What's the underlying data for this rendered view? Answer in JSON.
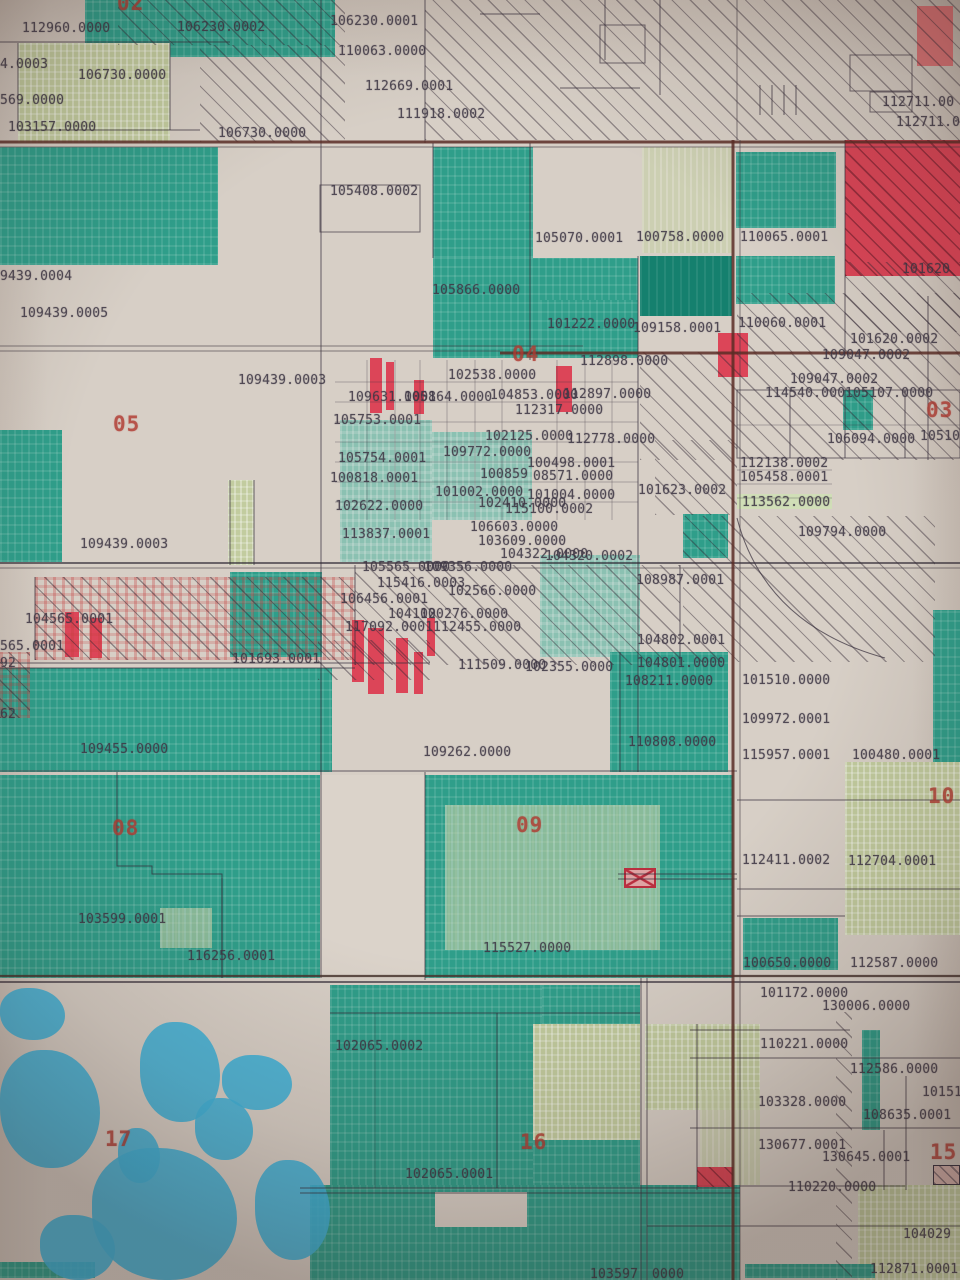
{
  "map": {
    "description": "Photographed cadastral parcel map with section numbers and parcel ID labels",
    "colors": {
      "paper": "#d7cfc6",
      "parcel_teal": "#2f9e8a",
      "parcel_teal_dark": "#15806e",
      "parcel_sage": "#c2cc9f",
      "parcel_red": "#dc3a4e",
      "water_blue": "#3fb3d9",
      "boundary_line": "#352d3a",
      "road_line": "#5a2d26",
      "label_text": "#3e3745",
      "section_text": "#b03a31"
    },
    "section_labels": [
      {
        "t": "02",
        "x": 117,
        "y": -7
      },
      {
        "t": "03",
        "x": 926,
        "y": 400
      },
      {
        "t": "04",
        "x": 512,
        "y": 344
      },
      {
        "t": "05",
        "x": 113,
        "y": 414
      },
      {
        "t": "08",
        "x": 112,
        "y": 818
      },
      {
        "t": "09",
        "x": 516,
        "y": 815
      },
      {
        "t": "10",
        "x": 928,
        "y": 786
      },
      {
        "t": "15",
        "x": 930,
        "y": 1142
      },
      {
        "t": "16",
        "x": 520,
        "y": 1132
      },
      {
        "t": "17",
        "x": 105,
        "y": 1129
      }
    ],
    "parcel_labels": [
      {
        "t": "112960.0000",
        "x": 22,
        "y": 22
      },
      {
        "t": "106230.0002",
        "x": 177,
        "y": 21
      },
      {
        "t": "4.0003",
        "x": 0,
        "y": 58
      },
      {
        "t": "106730.0000",
        "x": 78,
        "y": 69
      },
      {
        "t": "569.0000",
        "x": 0,
        "y": 94
      },
      {
        "t": "103157.0000",
        "x": 8,
        "y": 121
      },
      {
        "t": "106730.0000",
        "x": 218,
        "y": 127
      },
      {
        "t": "106230.0001",
        "x": 330,
        "y": 15
      },
      {
        "t": "110063.0000",
        "x": 338,
        "y": 45
      },
      {
        "t": "112669.0001",
        "x": 365,
        "y": 80
      },
      {
        "t": "111918.0002",
        "x": 397,
        "y": 108
      },
      {
        "t": "105408.0002",
        "x": 330,
        "y": 185
      },
      {
        "t": "105070.0001",
        "x": 535,
        "y": 232
      },
      {
        "t": "100758.0000",
        "x": 636,
        "y": 231
      },
      {
        "t": "110065.0001",
        "x": 740,
        "y": 231
      },
      {
        "t": "112711.00",
        "x": 882,
        "y": 96
      },
      {
        "t": "112711.0",
        "x": 896,
        "y": 116
      },
      {
        "t": "101620",
        "x": 902,
        "y": 263
      },
      {
        "t": "105866.0000",
        "x": 432,
        "y": 284
      },
      {
        "t": "101222.0000",
        "x": 547,
        "y": 318
      },
      {
        "t": "109158.0001",
        "x": 633,
        "y": 322
      },
      {
        "t": "110060.0001",
        "x": 738,
        "y": 317
      },
      {
        "t": "102538.0000",
        "x": 448,
        "y": 369
      },
      {
        "t": "109631.0001",
        "x": 348,
        "y": 391
      },
      {
        "t": "105864.0000",
        "x": 404,
        "y": 391
      },
      {
        "t": "104853.0000",
        "x": 490,
        "y": 389
      },
      {
        "t": "112897.0000",
        "x": 563,
        "y": 388
      },
      {
        "t": "112898.0000",
        "x": 580,
        "y": 355
      },
      {
        "t": "112317.0000",
        "x": 515,
        "y": 404
      },
      {
        "t": "105753.0001",
        "x": 333,
        "y": 414
      },
      {
        "t": "102125.0000",
        "x": 485,
        "y": 430
      },
      {
        "t": "112778.0000",
        "x": 567,
        "y": 433
      },
      {
        "t": "105754.0001",
        "x": 338,
        "y": 452
      },
      {
        "t": "109772.0000",
        "x": 443,
        "y": 446
      },
      {
        "t": "100818.0001",
        "x": 330,
        "y": 472
      },
      {
        "t": "100498.0001",
        "x": 527,
        "y": 457
      },
      {
        "t": "100859",
        "x": 480,
        "y": 468
      },
      {
        "t": "08571.0000",
        "x": 533,
        "y": 470
      },
      {
        "t": "101002.0000",
        "x": 435,
        "y": 486
      },
      {
        "t": "101004.0000",
        "x": 527,
        "y": 489
      },
      {
        "t": "102410.0000",
        "x": 478,
        "y": 497
      },
      {
        "t": "102622.0000",
        "x": 335,
        "y": 500
      },
      {
        "t": "115100.0002",
        "x": 505,
        "y": 503
      },
      {
        "t": "101620.0002",
        "x": 850,
        "y": 333
      },
      {
        "t": "109047.0002",
        "x": 822,
        "y": 349
      },
      {
        "t": "109047.0002",
        "x": 790,
        "y": 373
      },
      {
        "t": "114540.000",
        "x": 765,
        "y": 387
      },
      {
        "t": "105107.0000",
        "x": 845,
        "y": 387
      },
      {
        "t": "106094.0000",
        "x": 827,
        "y": 433
      },
      {
        "t": "10510",
        "x": 920,
        "y": 430
      },
      {
        "t": "112138.0002",
        "x": 740,
        "y": 457
      },
      {
        "t": "105458.0001",
        "x": 740,
        "y": 471
      },
      {
        "t": "101623.0002",
        "x": 638,
        "y": 484
      },
      {
        "t": "113562.0000",
        "x": 742,
        "y": 496
      },
      {
        "t": "9439.0004",
        "x": 0,
        "y": 270
      },
      {
        "t": "109439.0005",
        "x": 20,
        "y": 307
      },
      {
        "t": "109439.0003",
        "x": 238,
        "y": 374
      },
      {
        "t": "109439.0003",
        "x": 80,
        "y": 538
      },
      {
        "t": "104565.0001",
        "x": 25,
        "y": 613
      },
      {
        "t": "565.0001",
        "x": 0,
        "y": 640
      },
      {
        "t": "92",
        "x": 0,
        "y": 657
      },
      {
        "t": "101693.0001",
        "x": 232,
        "y": 653
      },
      {
        "t": "62",
        "x": 0,
        "y": 708
      },
      {
        "t": "109455.0000",
        "x": 80,
        "y": 743
      },
      {
        "t": "113837.0001",
        "x": 342,
        "y": 528
      },
      {
        "t": "106603.0000",
        "x": 470,
        "y": 521
      },
      {
        "t": "103609.0000",
        "x": 478,
        "y": 535
      },
      {
        "t": "104322.0000",
        "x": 500,
        "y": 548
      },
      {
        "t": "104320.0002",
        "x": 545,
        "y": 550
      },
      {
        "t": "105565.0000",
        "x": 362,
        "y": 561
      },
      {
        "t": "109356.0000",
        "x": 424,
        "y": 561
      },
      {
        "t": "115416.0003",
        "x": 377,
        "y": 577
      },
      {
        "t": "102566.0000",
        "x": 448,
        "y": 585
      },
      {
        "t": "106456.0001",
        "x": 340,
        "y": 593
      },
      {
        "t": "104102",
        "x": 388,
        "y": 608
      },
      {
        "t": "100276.0000",
        "x": 420,
        "y": 608
      },
      {
        "t": "117092.0001",
        "x": 345,
        "y": 621
      },
      {
        "t": "112455.0000",
        "x": 433,
        "y": 621
      },
      {
        "t": "111509.0000",
        "x": 458,
        "y": 659
      },
      {
        "t": "102355.0000",
        "x": 525,
        "y": 661
      },
      {
        "t": "108211.0000",
        "x": 625,
        "y": 675
      },
      {
        "t": "109262.0000",
        "x": 423,
        "y": 746
      },
      {
        "t": "109794.0000",
        "x": 798,
        "y": 526
      },
      {
        "t": "108987.0001",
        "x": 636,
        "y": 574
      },
      {
        "t": "104802.0001",
        "x": 637,
        "y": 634
      },
      {
        "t": "104801.0000",
        "x": 637,
        "y": 657
      },
      {
        "t": "101510.0000",
        "x": 742,
        "y": 674
      },
      {
        "t": "109972.0001",
        "x": 742,
        "y": 713
      },
      {
        "t": "110808.0000",
        "x": 628,
        "y": 736
      },
      {
        "t": "115957.0001",
        "x": 742,
        "y": 749
      },
      {
        "t": "100480.0001",
        "x": 852,
        "y": 749
      },
      {
        "t": "103599.0001",
        "x": 78,
        "y": 913
      },
      {
        "t": "116256.0001",
        "x": 187,
        "y": 950
      },
      {
        "t": "115527.0000",
        "x": 483,
        "y": 942
      },
      {
        "t": "112411.0002",
        "x": 742,
        "y": 854
      },
      {
        "t": "112704.0001",
        "x": 848,
        "y": 855
      },
      {
        "t": "100650.0000",
        "x": 743,
        "y": 957
      },
      {
        "t": "112587.0000",
        "x": 850,
        "y": 957
      },
      {
        "t": "101172.0000",
        "x": 760,
        "y": 987
      },
      {
        "t": "130006.0000",
        "x": 822,
        "y": 1000
      },
      {
        "t": "102065.0002",
        "x": 335,
        "y": 1040
      },
      {
        "t": "102065.0001",
        "x": 405,
        "y": 1168
      },
      {
        "t": "103597",
        "x": 590,
        "y": 1268
      },
      {
        "t": "110221.0000",
        "x": 760,
        "y": 1038
      },
      {
        "t": "112586.0000",
        "x": 850,
        "y": 1063
      },
      {
        "t": "10151",
        "x": 922,
        "y": 1086
      },
      {
        "t": "103328.0000",
        "x": 758,
        "y": 1096
      },
      {
        "t": "108635.0001",
        "x": 863,
        "y": 1109
      },
      {
        "t": "130677.0001",
        "x": 758,
        "y": 1139
      },
      {
        "t": "130645.0001",
        "x": 822,
        "y": 1151
      },
      {
        "t": "110220.0000",
        "x": 788,
        "y": 1181
      },
      {
        "t": "104029",
        "x": 903,
        "y": 1228
      },
      {
        "t": "112871.0001",
        "x": 870,
        "y": 1263
      },
      {
        "t": "0000",
        "x": 652,
        "y": 1268
      }
    ],
    "regions": [
      {
        "k": "t",
        "x": 85,
        "y": 0,
        "w": 250,
        "h": 57
      },
      {
        "k": "s",
        "x": 18,
        "y": 43,
        "w": 152,
        "h": 100
      },
      {
        "k": "t",
        "x": 0,
        "y": 147,
        "w": 218,
        "h": 118
      },
      {
        "k": "t",
        "x": 433,
        "y": 147,
        "w": 100,
        "h": 111
      },
      {
        "k": "sm",
        "x": 642,
        "y": 147,
        "w": 90,
        "h": 106
      },
      {
        "k": "t",
        "x": 736,
        "y": 152,
        "w": 100,
        "h": 76
      },
      {
        "k": "td",
        "x": 640,
        "y": 256,
        "w": 92,
        "h": 60
      },
      {
        "k": "t",
        "x": 736,
        "y": 256,
        "w": 99,
        "h": 48
      },
      {
        "k": "t",
        "x": 433,
        "y": 258,
        "w": 205,
        "h": 100
      },
      {
        "k": "t",
        "x": 540,
        "y": 300,
        "w": 98,
        "h": 58
      },
      {
        "k": "t",
        "x": 0,
        "y": 430,
        "w": 62,
        "h": 132
      },
      {
        "k": "tl",
        "x": 340,
        "y": 420,
        "w": 92,
        "h": 142
      },
      {
        "k": "tl",
        "x": 432,
        "y": 432,
        "w": 100,
        "h": 88
      },
      {
        "k": "s",
        "x": 228,
        "y": 480,
        "w": 26,
        "h": 85
      },
      {
        "k": "t",
        "x": 843,
        "y": 390,
        "w": 30,
        "h": 40
      },
      {
        "k": "t",
        "x": 683,
        "y": 514,
        "w": 45,
        "h": 44
      },
      {
        "k": "tl",
        "x": 540,
        "y": 555,
        "w": 100,
        "h": 102
      },
      {
        "k": "t",
        "x": 230,
        "y": 572,
        "w": 92,
        "h": 85
      },
      {
        "k": "t",
        "x": 0,
        "y": 668,
        "w": 332,
        "h": 104
      },
      {
        "k": "t",
        "x": 610,
        "y": 652,
        "w": 118,
        "h": 120
      },
      {
        "k": "t",
        "x": 933,
        "y": 610,
        "w": 27,
        "h": 165
      },
      {
        "k": "t",
        "x": 0,
        "y": 775,
        "w": 733,
        "h": 203
      },
      {
        "k": "s",
        "x": 845,
        "y": 762,
        "w": 115,
        "h": 173
      },
      {
        "k": "sm",
        "x": 445,
        "y": 805,
        "w": 215,
        "h": 145
      },
      {
        "k": "sm",
        "x": 160,
        "y": 908,
        "w": 52,
        "h": 40
      },
      {
        "k": "w",
        "x": 320,
        "y": 775,
        "w": 105,
        "h": 203
      },
      {
        "k": "t",
        "x": 743,
        "y": 918,
        "w": 95,
        "h": 52
      },
      {
        "k": "t",
        "x": 330,
        "y": 985,
        "w": 212,
        "h": 203
      },
      {
        "k": "t",
        "x": 542,
        "y": 985,
        "w": 98,
        "h": 40
      },
      {
        "k": "s",
        "x": 533,
        "y": 1024,
        "w": 107,
        "h": 116
      },
      {
        "k": "s",
        "x": 645,
        "y": 1024,
        "w": 115,
        "h": 86
      },
      {
        "k": "sm",
        "x": 700,
        "y": 1090,
        "w": 60,
        "h": 95
      },
      {
        "k": "t",
        "x": 862,
        "y": 1030,
        "w": 18,
        "h": 100
      },
      {
        "k": "t",
        "x": 533,
        "y": 1140,
        "w": 107,
        "h": 142
      },
      {
        "k": "t",
        "x": 310,
        "y": 1185,
        "w": 430,
        "h": 95
      },
      {
        "k": "s",
        "x": 858,
        "y": 1185,
        "w": 102,
        "h": 95
      },
      {
        "k": "w",
        "x": 435,
        "y": 1192,
        "w": 92,
        "h": 35
      },
      {
        "k": "t",
        "x": 0,
        "y": 1262,
        "w": 95,
        "h": 16
      },
      {
        "k": "t",
        "x": 745,
        "y": 1264,
        "w": 130,
        "h": 14
      },
      {
        "k": "g",
        "x": 737,
        "y": 494,
        "w": 95,
        "h": 15
      },
      {
        "k": "rrh",
        "x": 845,
        "y": 140,
        "w": 115,
        "h": 136
      },
      {
        "k": "rr",
        "x": 917,
        "y": 6,
        "w": 36,
        "h": 60
      },
      {
        "k": "r",
        "x": 370,
        "y": 358,
        "w": 12,
        "h": 55
      },
      {
        "k": "r",
        "x": 386,
        "y": 362,
        "w": 8,
        "h": 48
      },
      {
        "k": "r",
        "x": 414,
        "y": 380,
        "w": 10,
        "h": 34
      },
      {
        "k": "r",
        "x": 556,
        "y": 366,
        "w": 16,
        "h": 46
      },
      {
        "k": "r",
        "x": 718,
        "y": 333,
        "w": 30,
        "h": 44
      },
      {
        "k": "r",
        "x": 352,
        "y": 620,
        "w": 12,
        "h": 62
      },
      {
        "k": "r",
        "x": 368,
        "y": 628,
        "w": 16,
        "h": 66
      },
      {
        "k": "r",
        "x": 396,
        "y": 638,
        "w": 12,
        "h": 55
      },
      {
        "k": "r",
        "x": 414,
        "y": 652,
        "w": 9,
        "h": 42
      },
      {
        "k": "r",
        "x": 427,
        "y": 618,
        "w": 8,
        "h": 38
      },
      {
        "k": "r",
        "x": 65,
        "y": 612,
        "w": 14,
        "h": 45
      },
      {
        "k": "r",
        "x": 90,
        "y": 618,
        "w": 12,
        "h": 40
      },
      {
        "k": "xbox",
        "x": 624,
        "y": 868,
        "w": 32,
        "h": 20
      },
      {
        "k": "rrh",
        "x": 697,
        "y": 1167,
        "w": 36,
        "h": 20
      },
      {
        "k": "hb",
        "x": 933,
        "y": 1165,
        "w": 27,
        "h": 20
      },
      {
        "k": "h",
        "x": 118,
        "y": 0,
        "w": 227,
        "h": 45
      },
      {
        "k": "h",
        "x": 200,
        "y": 45,
        "w": 145,
        "h": 97
      },
      {
        "k": "h",
        "x": 425,
        "y": 0,
        "w": 535,
        "h": 140
      },
      {
        "k": "h",
        "x": 737,
        "y": 293,
        "w": 223,
        "h": 60
      },
      {
        "k": "h",
        "x": 640,
        "y": 352,
        "w": 320,
        "h": 108
      },
      {
        "k": "h",
        "x": 655,
        "y": 440,
        "w": 82,
        "h": 75
      },
      {
        "k": "h",
        "x": 845,
        "y": 262,
        "w": 115,
        "h": 70
      },
      {
        "k": "hr",
        "x": 35,
        "y": 577,
        "w": 320,
        "h": 83
      },
      {
        "k": "h",
        "x": 355,
        "y": 565,
        "w": 325,
        "h": 100
      },
      {
        "k": "h",
        "x": 318,
        "y": 640,
        "w": 112,
        "h": 40
      },
      {
        "k": "h",
        "x": 683,
        "y": 516,
        "w": 252,
        "h": 146
      },
      {
        "k": "h",
        "x": 836,
        "y": 1012,
        "w": 16,
        "h": 268
      },
      {
        "k": "hr",
        "x": 0,
        "y": 652,
        "w": 30,
        "h": 66
      },
      {
        "k": "b",
        "x": 0,
        "y": 988,
        "w": 65,
        "h": 52
      },
      {
        "k": "b",
        "x": 0,
        "y": 1050,
        "w": 100,
        "h": 118
      },
      {
        "k": "b",
        "x": 140,
        "y": 1022,
        "w": 80,
        "h": 100
      },
      {
        "k": "b",
        "x": 222,
        "y": 1055,
        "w": 70,
        "h": 55
      },
      {
        "k": "b",
        "x": 195,
        "y": 1098,
        "w": 58,
        "h": 62
      },
      {
        "k": "b",
        "x": 118,
        "y": 1128,
        "w": 42,
        "h": 55
      },
      {
        "k": "b",
        "x": 92,
        "y": 1148,
        "w": 145,
        "h": 132
      },
      {
        "k": "b",
        "x": 40,
        "y": 1215,
        "w": 75,
        "h": 65
      },
      {
        "k": "b",
        "x": 255,
        "y": 1160,
        "w": 75,
        "h": 100
      }
    ]
  }
}
